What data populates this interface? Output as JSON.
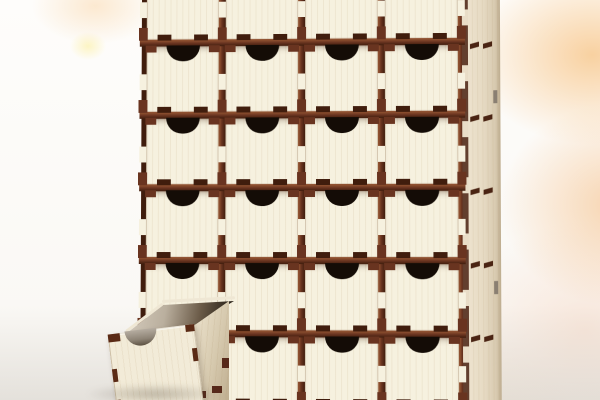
{
  "scene": {
    "type": "3d-product-render",
    "subject": "Laser-cut plywood organizer cabinet with dark brown frame and cream drawer fronts; each drawer has a half-round finger notch; the bottom-left drawer is pulled out toward the lower left; soft white background with peach/orange glow on the right",
    "cabinet": {
      "columns": 4,
      "rows": 6,
      "drawer_count": 24,
      "notch_shape": "semicircle",
      "joinery": "finger-joint tabs",
      "open_slot": {
        "row": 6,
        "column": 1
      }
    },
    "pulled_drawer": {
      "row": 6,
      "column": 1,
      "state": "pulled out, angled toward lower left"
    },
    "side_panel": {
      "shelf_slot_y": [
        74,
        147,
        220,
        293,
        366
      ],
      "rear_slot_y": [
        122,
        312
      ]
    },
    "colors": {
      "frame_brown": "#693420",
      "frame_brown_light": "#8f5130",
      "frame_brown_dark": "#401d0d",
      "drawer_front_cream": "#f6f1df",
      "pulled_drawer_front": "#f2ebd8",
      "side_panel_tan": "#ece1cb",
      "notch_shadow": "#140c06",
      "drawer_interior_dark": "#2e261c",
      "background_peach": "#f7c68a",
      "background_cream": "#fdf0d9",
      "floor_gray": "#cbc6be"
    }
  }
}
